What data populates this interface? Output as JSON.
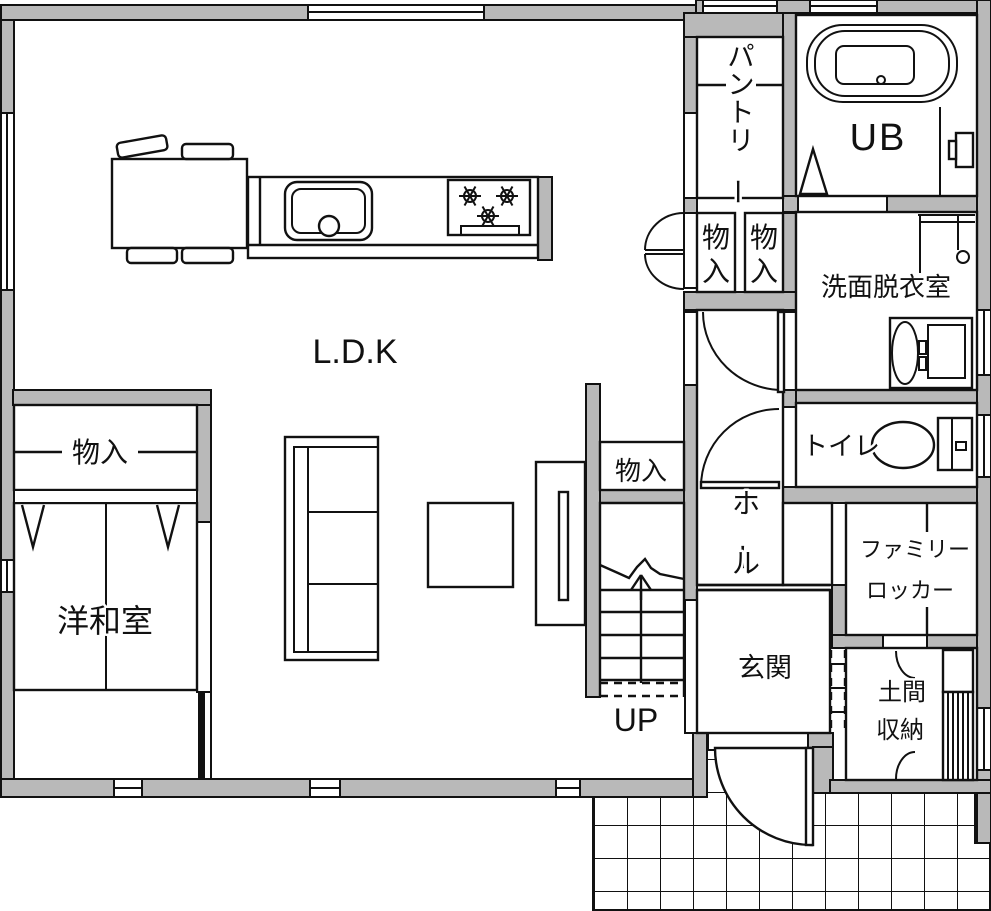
{
  "title": "1F floor plan",
  "colors": {
    "wall": "#b9b9b9",
    "line": "#111111",
    "bg": "#ffffff"
  },
  "labels": {
    "ldk": "L.D.K",
    "pantry": "パントリー",
    "ub": "UB",
    "washroom": "洗面脱衣室",
    "toilet": "トイレ",
    "hall": "ホール",
    "storage_hall_1": "物入",
    "storage_hall_2": "物入",
    "storage_stairs": "物入",
    "storage_japanese_room": "物入",
    "japanese_room": "洋和室",
    "genkan": "玄関",
    "doma_line1": "土間",
    "doma_line2": "収納",
    "family_locker_line1": "ファミリー",
    "family_locker_line2": "ロッカー",
    "stairs_up": "UP"
  }
}
